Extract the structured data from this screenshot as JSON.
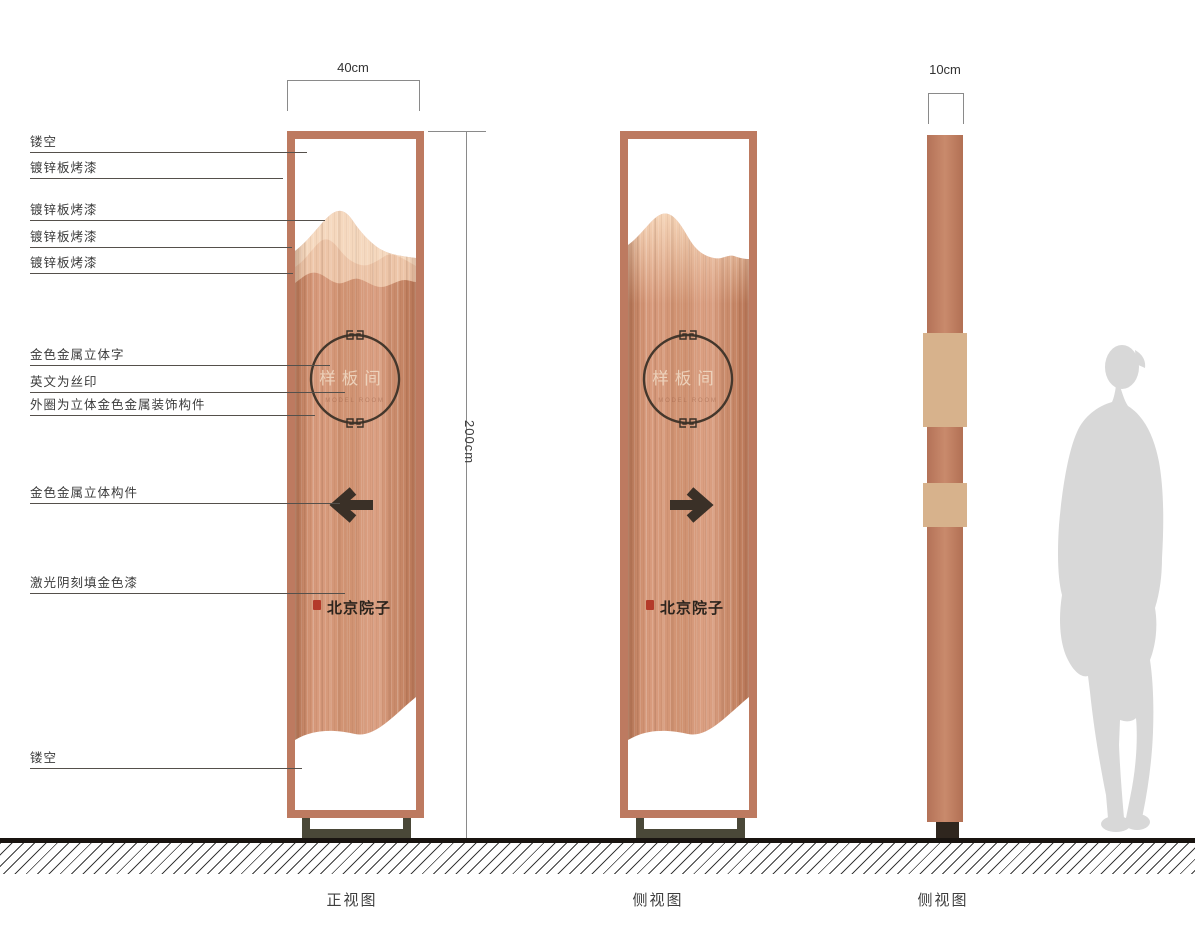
{
  "drawing": {
    "captions": [
      "正视图",
      "侧视图",
      "侧视图"
    ],
    "dimensions": {
      "front_width": "40cm",
      "total_height": "200cm",
      "side_thickness": "10cm"
    },
    "annotations": [
      "镂空",
      "镀锌板烤漆",
      "镀锌板烤漆",
      "镀锌板烤漆",
      "镀锌板烤漆",
      "金色金属立体字",
      "英文为丝印",
      "外圈为立体金色金属装饰构件",
      "金色金属立体构件",
      "激光阴刻填金色漆",
      "镂空"
    ],
    "sign": {
      "title": "样板间",
      "subtitle_en_faint": "MODEL ROOM",
      "logo": "北京院子",
      "front_arrow_direction": "left",
      "side_arrow_direction": "right"
    },
    "colors": {
      "frame_copper": "#bd7a60",
      "panel_copper": "#cf9170",
      "mountain_light": "#f5d8be",
      "mountain_mid": "#edc5a8",
      "detail_dark": "#3a3027",
      "base_olive": "#4a4838",
      "seal_red": "#b43a2a",
      "silhouette_gray": "#d8d8d8"
    }
  }
}
